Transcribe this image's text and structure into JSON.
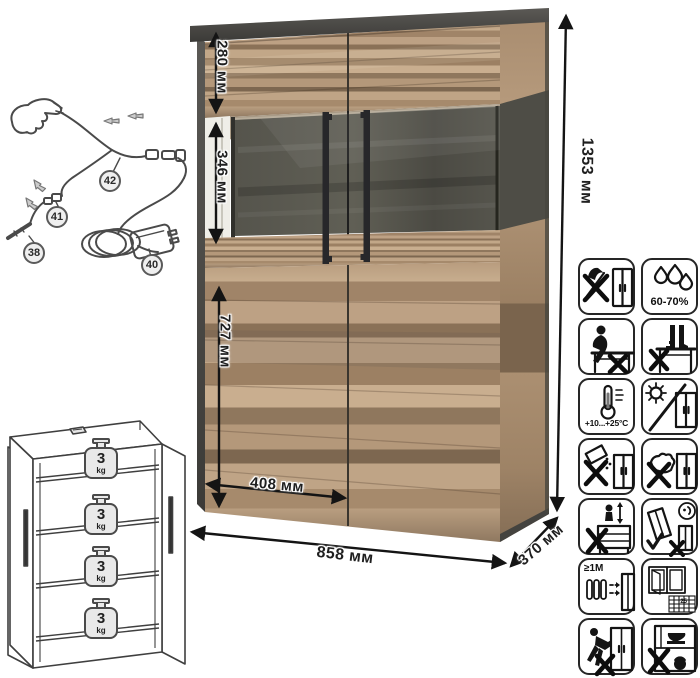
{
  "product": {
    "kind": "display cabinet with glass section and LED kit"
  },
  "dimensions": {
    "height_total": "1353 мм",
    "width_total": "858 мм",
    "depth_total": "370 мм",
    "top_section_height": "280 мм",
    "glass_section_height": "346 мм",
    "door_height": "727 мм",
    "door_width": "408 мм"
  },
  "lighting_kit": {
    "callouts": {
      "c38": "38",
      "c40": "40",
      "c41": "41",
      "c42": "42"
    }
  },
  "shelf_load": {
    "value": "3",
    "unit": "kg"
  },
  "care": {
    "humidity": "60-70%",
    "temperature": "+10...+25°С",
    "min_distance": "≥1М",
    "ventilation_days": "25"
  },
  "care_icons": [
    {
      "name": "no-sharp-tools-icon"
    },
    {
      "name": "humidity-range-icon"
    },
    {
      "name": "no-sitting-icon"
    },
    {
      "name": "no-standing-icon"
    },
    {
      "name": "temperature-range-icon"
    },
    {
      "name": "no-direct-sunlight-icon"
    },
    {
      "name": "no-spilling-liquids-icon"
    },
    {
      "name": "no-abrasive-cleaning-icon"
    },
    {
      "name": "no-jumping-icon"
    },
    {
      "name": "assemble-tilted-icon"
    },
    {
      "name": "keep-distance-from-heat-icon"
    },
    {
      "name": "ventilate-room-icon"
    },
    {
      "name": "no-dragging-icon"
    },
    {
      "name": "no-heavy-objects-inside-icon"
    }
  ],
  "colors": {
    "wood": "#b3977a",
    "graphite": "#4a4947",
    "line_art": "#4a4a4a"
  }
}
